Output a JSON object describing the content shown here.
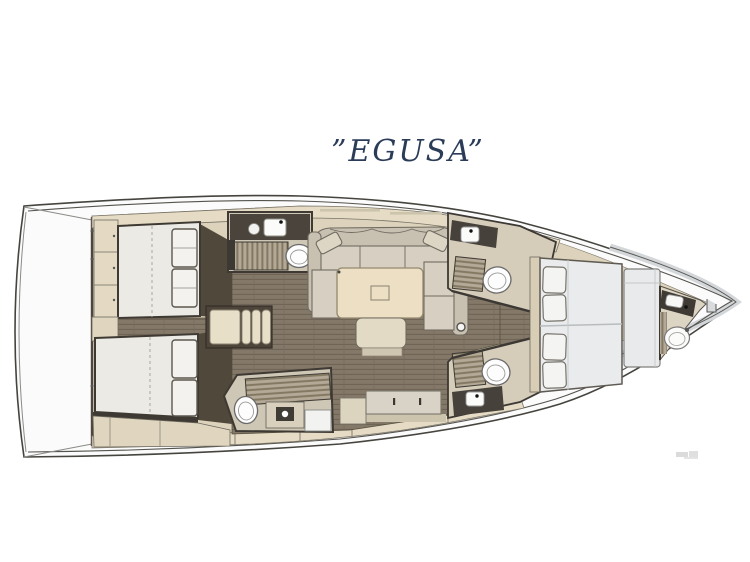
{
  "title": {
    "text": "”EGUSA”",
    "color": "#2b3c58"
  },
  "plan": {
    "type": "yacht-interior-floor-plan",
    "orientation": "bow-right",
    "colors": {
      "title_navy": "#2b3c58",
      "hull_white": "#fbfbfc",
      "outline_dark": "#46443e",
      "joinery_beige": "#ddd3bc",
      "panel_beige": "#e6dcc6",
      "floor_brown": "#847868",
      "wall_dark": "#3e3a33",
      "mattress_white": "#eceae5",
      "forward_mattress": "#e9ebec",
      "sofa_fabric": "#d7d0c2",
      "fixture_white": "#fbfbfa",
      "shower_grate": "#b3a996",
      "toe_rail_gray": "#d4d7da",
      "watermark_gray": "#bfbfbf"
    },
    "regions": [
      {
        "id": "stern-platform",
        "label": "Stern platform"
      },
      {
        "id": "aft-cabin-port",
        "label": "Aft cabin (port)"
      },
      {
        "id": "aft-cabin-starboard",
        "label": "Aft cabin (starboard)"
      },
      {
        "id": "aft-head-port",
        "label": "Aft head with shower (port)"
      },
      {
        "id": "aft-head-starboard",
        "label": "Aft head with shower (starboard)"
      },
      {
        "id": "companionway-steps",
        "label": "Companionway steps"
      },
      {
        "id": "salon",
        "label": "Salon with U-sofa and table"
      },
      {
        "id": "galley-sideboard",
        "label": "Galley sideboard"
      },
      {
        "id": "forward-head-port",
        "label": "Forward head (port)"
      },
      {
        "id": "forward-head-starboard",
        "label": "Forward head (starboard)"
      },
      {
        "id": "forward-cabin",
        "label": "Forward owner cabin"
      },
      {
        "id": "bow-head",
        "label": "Bow head"
      },
      {
        "id": "mast-post",
        "label": "Mast compression post"
      }
    ]
  }
}
